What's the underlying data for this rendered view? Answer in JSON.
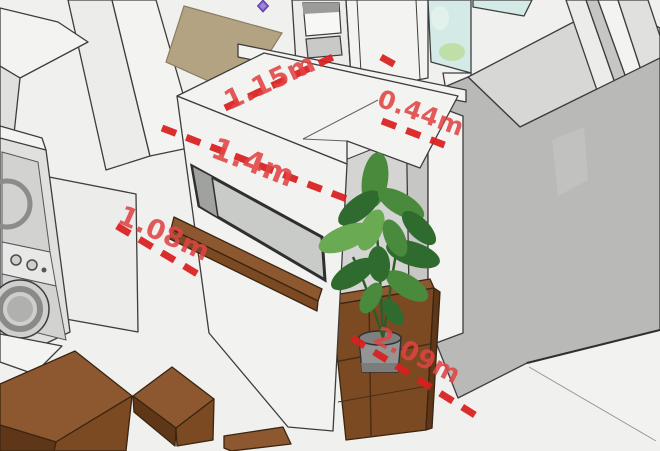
{
  "dimension_labels": [
    {
      "name": "partition-top-depth",
      "label": "1.15m"
    },
    {
      "name": "partition-front-width",
      "label": "1.4m"
    },
    {
      "name": "doorway-gap-width",
      "label": "0.44m"
    },
    {
      "name": "left-aisle-width",
      "label": "1.08m"
    },
    {
      "name": "room-diagonal-length",
      "label": "2.09m"
    }
  ],
  "colors": {
    "dimension_red": "#d81f1f",
    "dimension_text_red": "#e04444",
    "wall_white": "#f3f3f1",
    "wall_gray": "#b9b9b7",
    "floor_white": "#f0f0ee",
    "tan_wall": "#b3a383",
    "wood_brown": "#7c4a22",
    "wood_brown_light": "#8d5830",
    "wood_brown_dark": "#5f3718",
    "plant_green_dark": "#2f6b2e",
    "plant_green_mid": "#4a8a3d",
    "plant_green_light": "#6aaa52",
    "glass_blue": "#d3eae6",
    "glass_green": "#bfdfa8",
    "pot_gray": "#939694",
    "marker_purple": "#7b5ec7"
  }
}
